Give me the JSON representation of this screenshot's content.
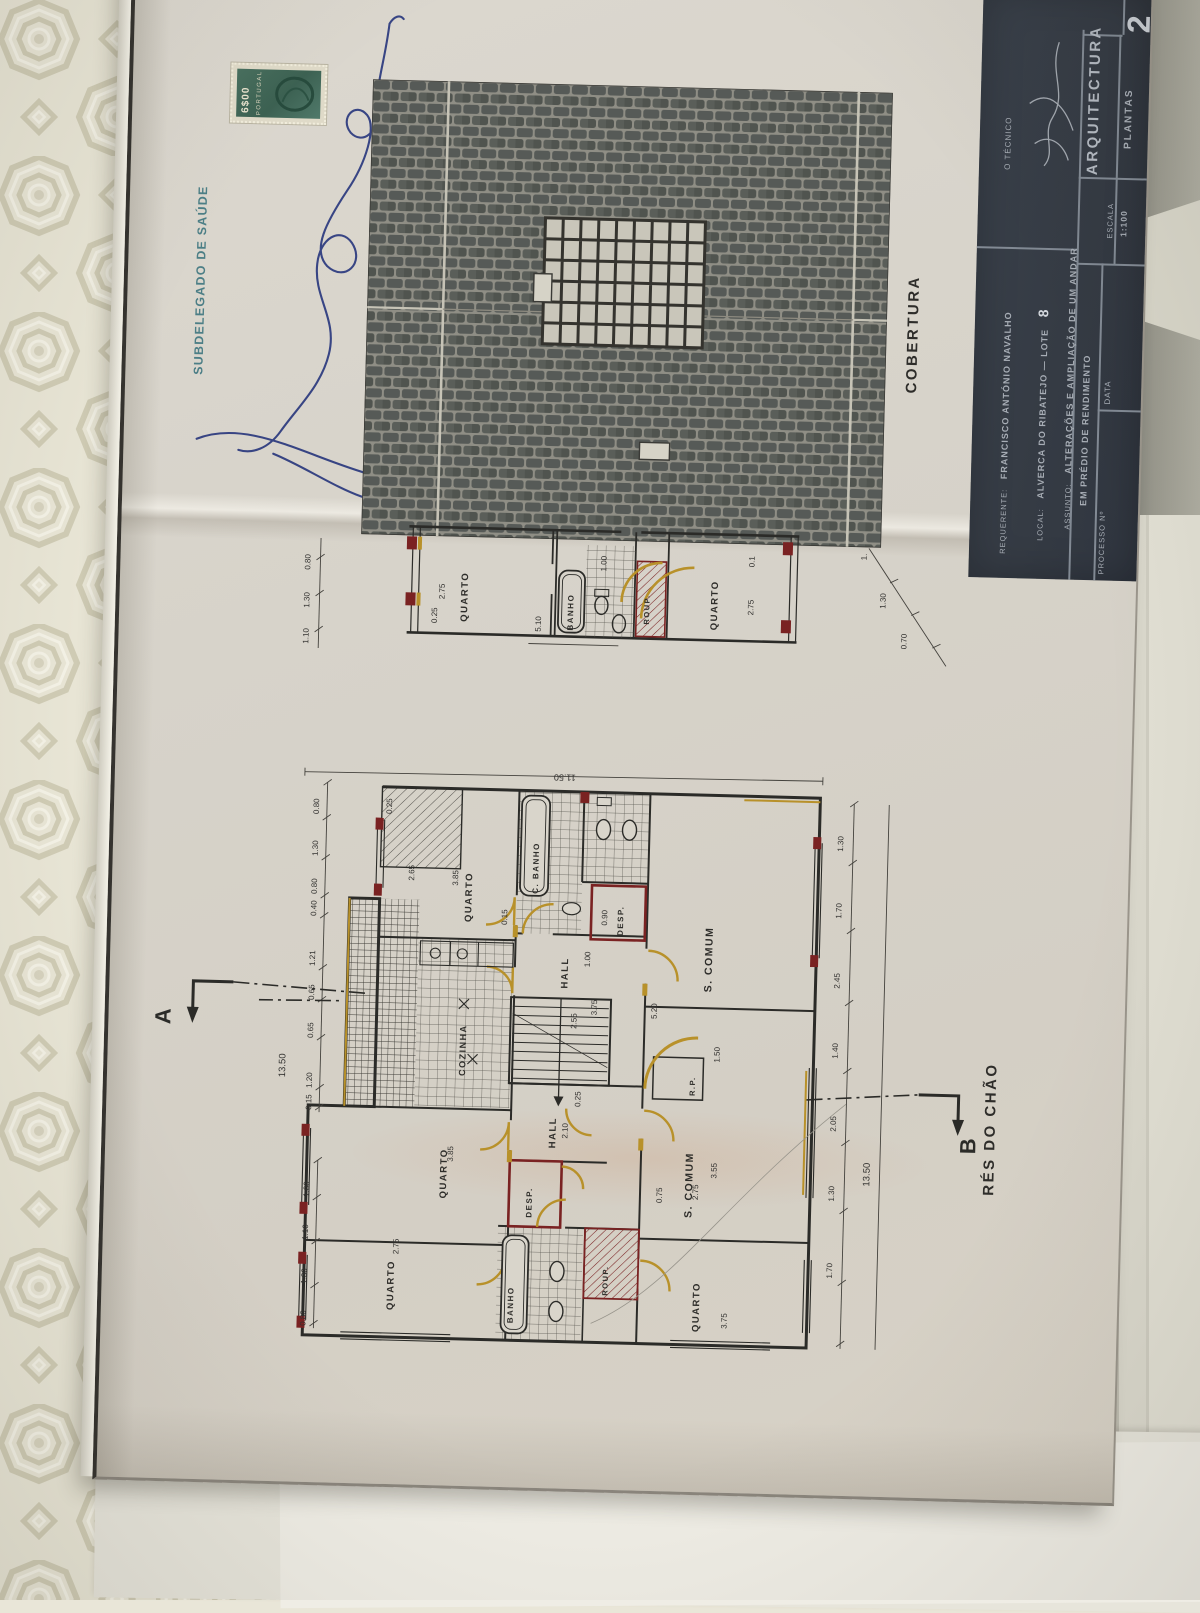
{
  "revenue_stamp": {
    "value": "6$00",
    "country": "PORTUGAL"
  },
  "health_stamp": {
    "office": "SUBDELEGADO DE SAÚDE"
  },
  "roof_plan": {
    "caption": "COBERTURA"
  },
  "upper_plan": {
    "rooms": {
      "quarto_left": "QUARTO",
      "banho": "BANHO",
      "roup": "ROUP.",
      "quarto_right": "QUARTO"
    },
    "dims": {
      "sill": "0.25",
      "quarto_left_w": "2.75",
      "banho_w": "5.10",
      "door": "1.00",
      "quarto_right_w": "2.75",
      "wall": "0.1"
    },
    "left_chain": [
      "0.80",
      "1.30",
      "1.10"
    ],
    "right_chain": [
      "1.",
      "1.30",
      "0.70"
    ]
  },
  "main_plan": {
    "caption": "RÉS DO CHÃO",
    "section_a": "A",
    "section_b": "B",
    "overall_top": "11.50",
    "overall_left": "13.50",
    "overall_right": "13.50",
    "rooms": {
      "quarto_ul": "QUARTO",
      "c_banho": "C. BANHO",
      "desp_u": "DESP.",
      "hall_u": "HALL",
      "s_comum_u": "S. COMUM",
      "cozinha": "COZINHA",
      "rp": "R.P.",
      "hall_l": "HALL",
      "quarto_ml": "QUARTO",
      "s_comum_l": "S. COMUM",
      "desp_l": "DESP.",
      "banho_l": "BANHO",
      "roup_l": "ROUP.",
      "quarto_bl": "QUARTO",
      "quarto_br": "QUARTO"
    },
    "left_chain": [
      "0.80",
      "1.30",
      "0.80",
      "0.40",
      "1.21",
      "0.65",
      "0.65",
      "1.20",
      "0.15"
    ],
    "left_chain_bottom": [
      "1.00",
      "1.10",
      "1.30",
      "0.80"
    ],
    "right_chain": [
      "1.30",
      "1.70",
      "2.45",
      "1.40",
      "2.05",
      "1.30",
      "1.70"
    ],
    "inner_dims": {
      "quarto_ul_w": "2.65",
      "quarto_ul_l": "3.85",
      "sill": "0.25",
      "wall": "0.15",
      "scomum_u_l": "5.20",
      "stair_w": "2.55",
      "stair_l": "3.75",
      "hall_l_w": "2.10",
      "hall_wall": "0.25",
      "desp_w": "0.90",
      "desp_d": "1.00",
      "scomum_l_w": "2.75",
      "scomum_l_l": "3.55",
      "nook": "0.75",
      "quarto_ml_l": "3.85",
      "quarto_bl_w": "2.75",
      "quarto_br_l": "3.75",
      "balcony": "1.50"
    }
  },
  "title_block": {
    "sheet_no": "2",
    "tecnico_label": "O TÉCNICO",
    "discipline": "ARQUITECTURA",
    "content": "PLANTAS",
    "escala_label": "ESCALA",
    "escala_value": "1:100",
    "data_label": "DATA",
    "processo_label": "PROCESSO Nº",
    "requerente_label": "REQUERENTE:",
    "requerente_value": "FRANCISCO ANTÓNIO NAVALHO",
    "local_label": "LOCAL:",
    "local_value": "ALVERCA DO RIBATEJO — LOTE",
    "lote": "8",
    "assunto_label": "ASSUNTO:",
    "assunto_line1": "ALTERAÇÕES E AMPLIAÇÃO DE UM ANDAR",
    "assunto_line2": "EM PRÉDIO DE RENDIMENTO"
  },
  "colors": {
    "door_gold": "#b8912a",
    "new_wall_red": "#7a2222",
    "ink": "#2b2b28",
    "title_bg": "#373d46"
  }
}
